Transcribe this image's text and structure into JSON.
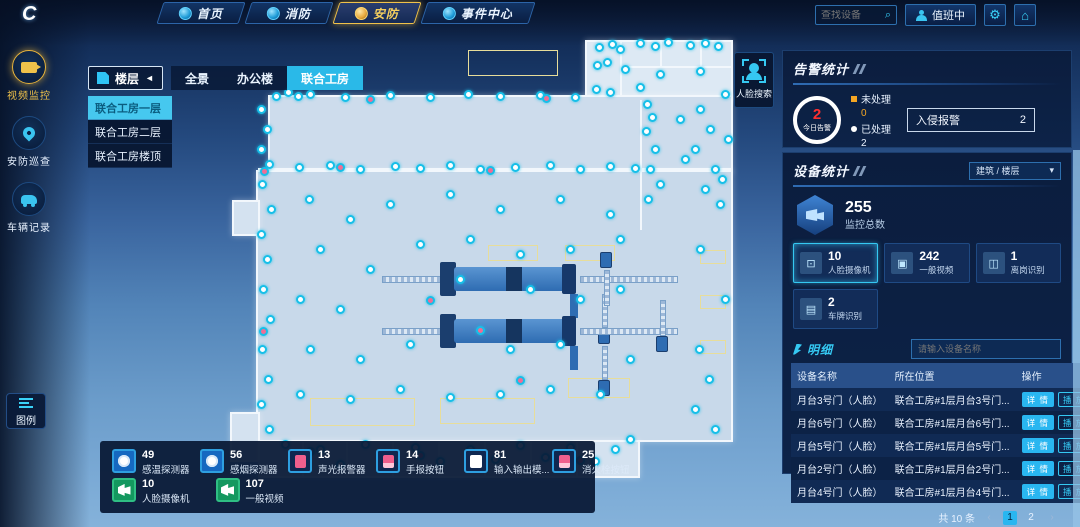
{
  "colors": {
    "accent": "#2fc4f5",
    "gold": "#f0c24a",
    "alert_red": "#ff2f2f",
    "warn_orange": "#f5a623",
    "pink": "#ef5f8d",
    "green": "#14985f"
  },
  "topbar": {
    "tabs": [
      {
        "label": "首页",
        "active": false
      },
      {
        "label": "消防",
        "active": false
      },
      {
        "label": "安防",
        "active": true
      },
      {
        "label": "事件中心",
        "active": false
      }
    ],
    "search_placeholder": "查找设备",
    "duty_label": "值班中"
  },
  "sidebar": {
    "items": [
      {
        "label": "视频监控",
        "active": true
      },
      {
        "label": "安防巡查",
        "active": false
      },
      {
        "label": "车辆记录",
        "active": false
      }
    ],
    "legend_label": "图例"
  },
  "floor_controls": {
    "floor_button": "楼层",
    "collapse_arrow": "◄",
    "tabs": [
      {
        "label": "全景",
        "active": false
      },
      {
        "label": "办公楼",
        "active": false
      },
      {
        "label": "联合工房",
        "active": true
      }
    ],
    "dropdown": [
      {
        "label": "联合工房一层",
        "active": true
      },
      {
        "label": "联合工房二层",
        "active": false
      },
      {
        "label": "联合工房楼顶",
        "active": false
      }
    ]
  },
  "face_search_label": "人脸搜索",
  "alarm_panel": {
    "title": "告警统计",
    "today_value": "2",
    "today_label": "今日告警",
    "unprocessed_label": "未处理",
    "unprocessed_value": "0",
    "processed_label": "已处理",
    "processed_value": "2",
    "intrusion_label": "入侵报警",
    "intrusion_value": "2"
  },
  "device_panel": {
    "title": "设备统计",
    "filter_label": "建筑 / 楼层",
    "filter_caret": "▾",
    "total_value": "255",
    "total_label": "监控总数",
    "cards": [
      {
        "value": "10",
        "label": "人脸摄像机",
        "active": true
      },
      {
        "value": "242",
        "label": "一般视频",
        "active": false
      },
      {
        "value": "1",
        "label": "离岗识别",
        "active": false
      },
      {
        "value": "2",
        "label": "车牌识别",
        "active": false
      }
    ]
  },
  "detail": {
    "title": "明细",
    "search_placeholder": "请输入设备名称",
    "columns": [
      "设备名称",
      "所在位置",
      "操作"
    ],
    "rows": [
      {
        "name": "月台3号门（人脸）",
        "location": "联合工房#1层月台3号门..."
      },
      {
        "name": "月台6号门（人脸）",
        "location": "联合工房#1层月台6号门..."
      },
      {
        "name": "月台5号门（人脸）",
        "location": "联合工房#1层月台5号门..."
      },
      {
        "name": "月台2号门（人脸）",
        "location": "联合工房#1层月台2号门..."
      },
      {
        "name": "月台4号门（人脸）",
        "location": "联合工房#1层月台4号门..."
      }
    ],
    "actions": [
      "详 情",
      "播 放",
      "回 放"
    ],
    "pagination": {
      "total": "共 10 条",
      "prev": "‹",
      "next": "›",
      "pages": [
        "1",
        "2"
      ],
      "active_page": "1"
    }
  },
  "legend": {
    "items": [
      {
        "value": "49",
        "label": "感温探测器"
      },
      {
        "value": "56",
        "label": "感烟探测器"
      },
      {
        "value": "13",
        "label": "声光报警器"
      },
      {
        "value": "14",
        "label": "手报按钮"
      },
      {
        "value": "81",
        "label": "输入输出模..."
      },
      {
        "value": "25",
        "label": "消火栓按钮"
      },
      {
        "value": "10",
        "label": "人脸摄像机"
      },
      {
        "value": "107",
        "label": "一般视频"
      }
    ]
  },
  "map": {
    "markers": [
      [
        277,
        97
      ],
      [
        289,
        93
      ],
      [
        299,
        97
      ],
      [
        311,
        95
      ],
      [
        346,
        98
      ],
      [
        371,
        100,
        "p"
      ],
      [
        391,
        96
      ],
      [
        431,
        98
      ],
      [
        469,
        95
      ],
      [
        501,
        97
      ],
      [
        541,
        96
      ],
      [
        547,
        99,
        "p"
      ],
      [
        576,
        98
      ],
      [
        611,
        93
      ],
      [
        600,
        48
      ],
      [
        613,
        45
      ],
      [
        621,
        50
      ],
      [
        641,
        44
      ],
      [
        656,
        47
      ],
      [
        669,
        43
      ],
      [
        691,
        46
      ],
      [
        706,
        44
      ],
      [
        719,
        47
      ],
      [
        598,
        66
      ],
      [
        608,
        63
      ],
      [
        626,
        70
      ],
      [
        661,
        75
      ],
      [
        701,
        72
      ],
      [
        641,
        88
      ],
      [
        597,
        90
      ],
      [
        648,
        105
      ],
      [
        653,
        118
      ],
      [
        647,
        132
      ],
      [
        656,
        150
      ],
      [
        651,
        170
      ],
      [
        661,
        185
      ],
      [
        649,
        200
      ],
      [
        701,
        110
      ],
      [
        711,
        130
      ],
      [
        696,
        150
      ],
      [
        716,
        170
      ],
      [
        706,
        190
      ],
      [
        721,
        205
      ],
      [
        681,
        120
      ],
      [
        686,
        160
      ],
      [
        726,
        95
      ],
      [
        729,
        140
      ],
      [
        723,
        180
      ],
      [
        262,
        110
      ],
      [
        268,
        130
      ],
      [
        262,
        150
      ],
      [
        270,
        165
      ],
      [
        265,
        172,
        "p"
      ],
      [
        263,
        185
      ],
      [
        272,
        210
      ],
      [
        262,
        235
      ],
      [
        268,
        260
      ],
      [
        264,
        290
      ],
      [
        271,
        320
      ],
      [
        264,
        332,
        "p"
      ],
      [
        263,
        350
      ],
      [
        269,
        380
      ],
      [
        262,
        405
      ],
      [
        270,
        430
      ],
      [
        300,
        168
      ],
      [
        331,
        166
      ],
      [
        341,
        168,
        "p"
      ],
      [
        361,
        170
      ],
      [
        396,
        167
      ],
      [
        421,
        169
      ],
      [
        451,
        166
      ],
      [
        481,
        170
      ],
      [
        491,
        171,
        "p"
      ],
      [
        516,
        168
      ],
      [
        551,
        166
      ],
      [
        581,
        170
      ],
      [
        611,
        167
      ],
      [
        636,
        169
      ],
      [
        310,
        200
      ],
      [
        351,
        220
      ],
      [
        391,
        205
      ],
      [
        451,
        195
      ],
      [
        501,
        210
      ],
      [
        561,
        200
      ],
      [
        611,
        215
      ],
      [
        321,
        250
      ],
      [
        371,
        270
      ],
      [
        421,
        245
      ],
      [
        471,
        240
      ],
      [
        521,
        255
      ],
      [
        571,
        250
      ],
      [
        621,
        240
      ],
      [
        301,
        300
      ],
      [
        341,
        310
      ],
      [
        431,
        301,
        "p"
      ],
      [
        461,
        280
      ],
      [
        531,
        290
      ],
      [
        581,
        300
      ],
      [
        621,
        290
      ],
      [
        311,
        350
      ],
      [
        361,
        360
      ],
      [
        411,
        345
      ],
      [
        481,
        331,
        "p"
      ],
      [
        511,
        350
      ],
      [
        561,
        345
      ],
      [
        301,
        395
      ],
      [
        351,
        400
      ],
      [
        401,
        390
      ],
      [
        451,
        398
      ],
      [
        501,
        395
      ],
      [
        521,
        381,
        "p"
      ],
      [
        551,
        390
      ],
      [
        601,
        395
      ],
      [
        631,
        360
      ],
      [
        700,
        350
      ],
      [
        710,
        380
      ],
      [
        696,
        410
      ],
      [
        716,
        430
      ],
      [
        726,
        300
      ],
      [
        701,
        250
      ],
      [
        286,
        445
      ],
      [
        301,
        460
      ],
      [
        311,
        452,
        "p"
      ],
      [
        321,
        450
      ],
      [
        341,
        465
      ],
      [
        366,
        445
      ],
      [
        391,
        458
      ],
      [
        416,
        448
      ],
      [
        421,
        456,
        "p"
      ],
      [
        441,
        462
      ],
      [
        471,
        450
      ],
      [
        496,
        460
      ],
      [
        521,
        446
      ],
      [
        546,
        458
      ],
      [
        571,
        448
      ],
      [
        581,
        461,
        "p"
      ],
      [
        596,
        462
      ],
      [
        616,
        450
      ],
      [
        631,
        440
      ]
    ]
  }
}
